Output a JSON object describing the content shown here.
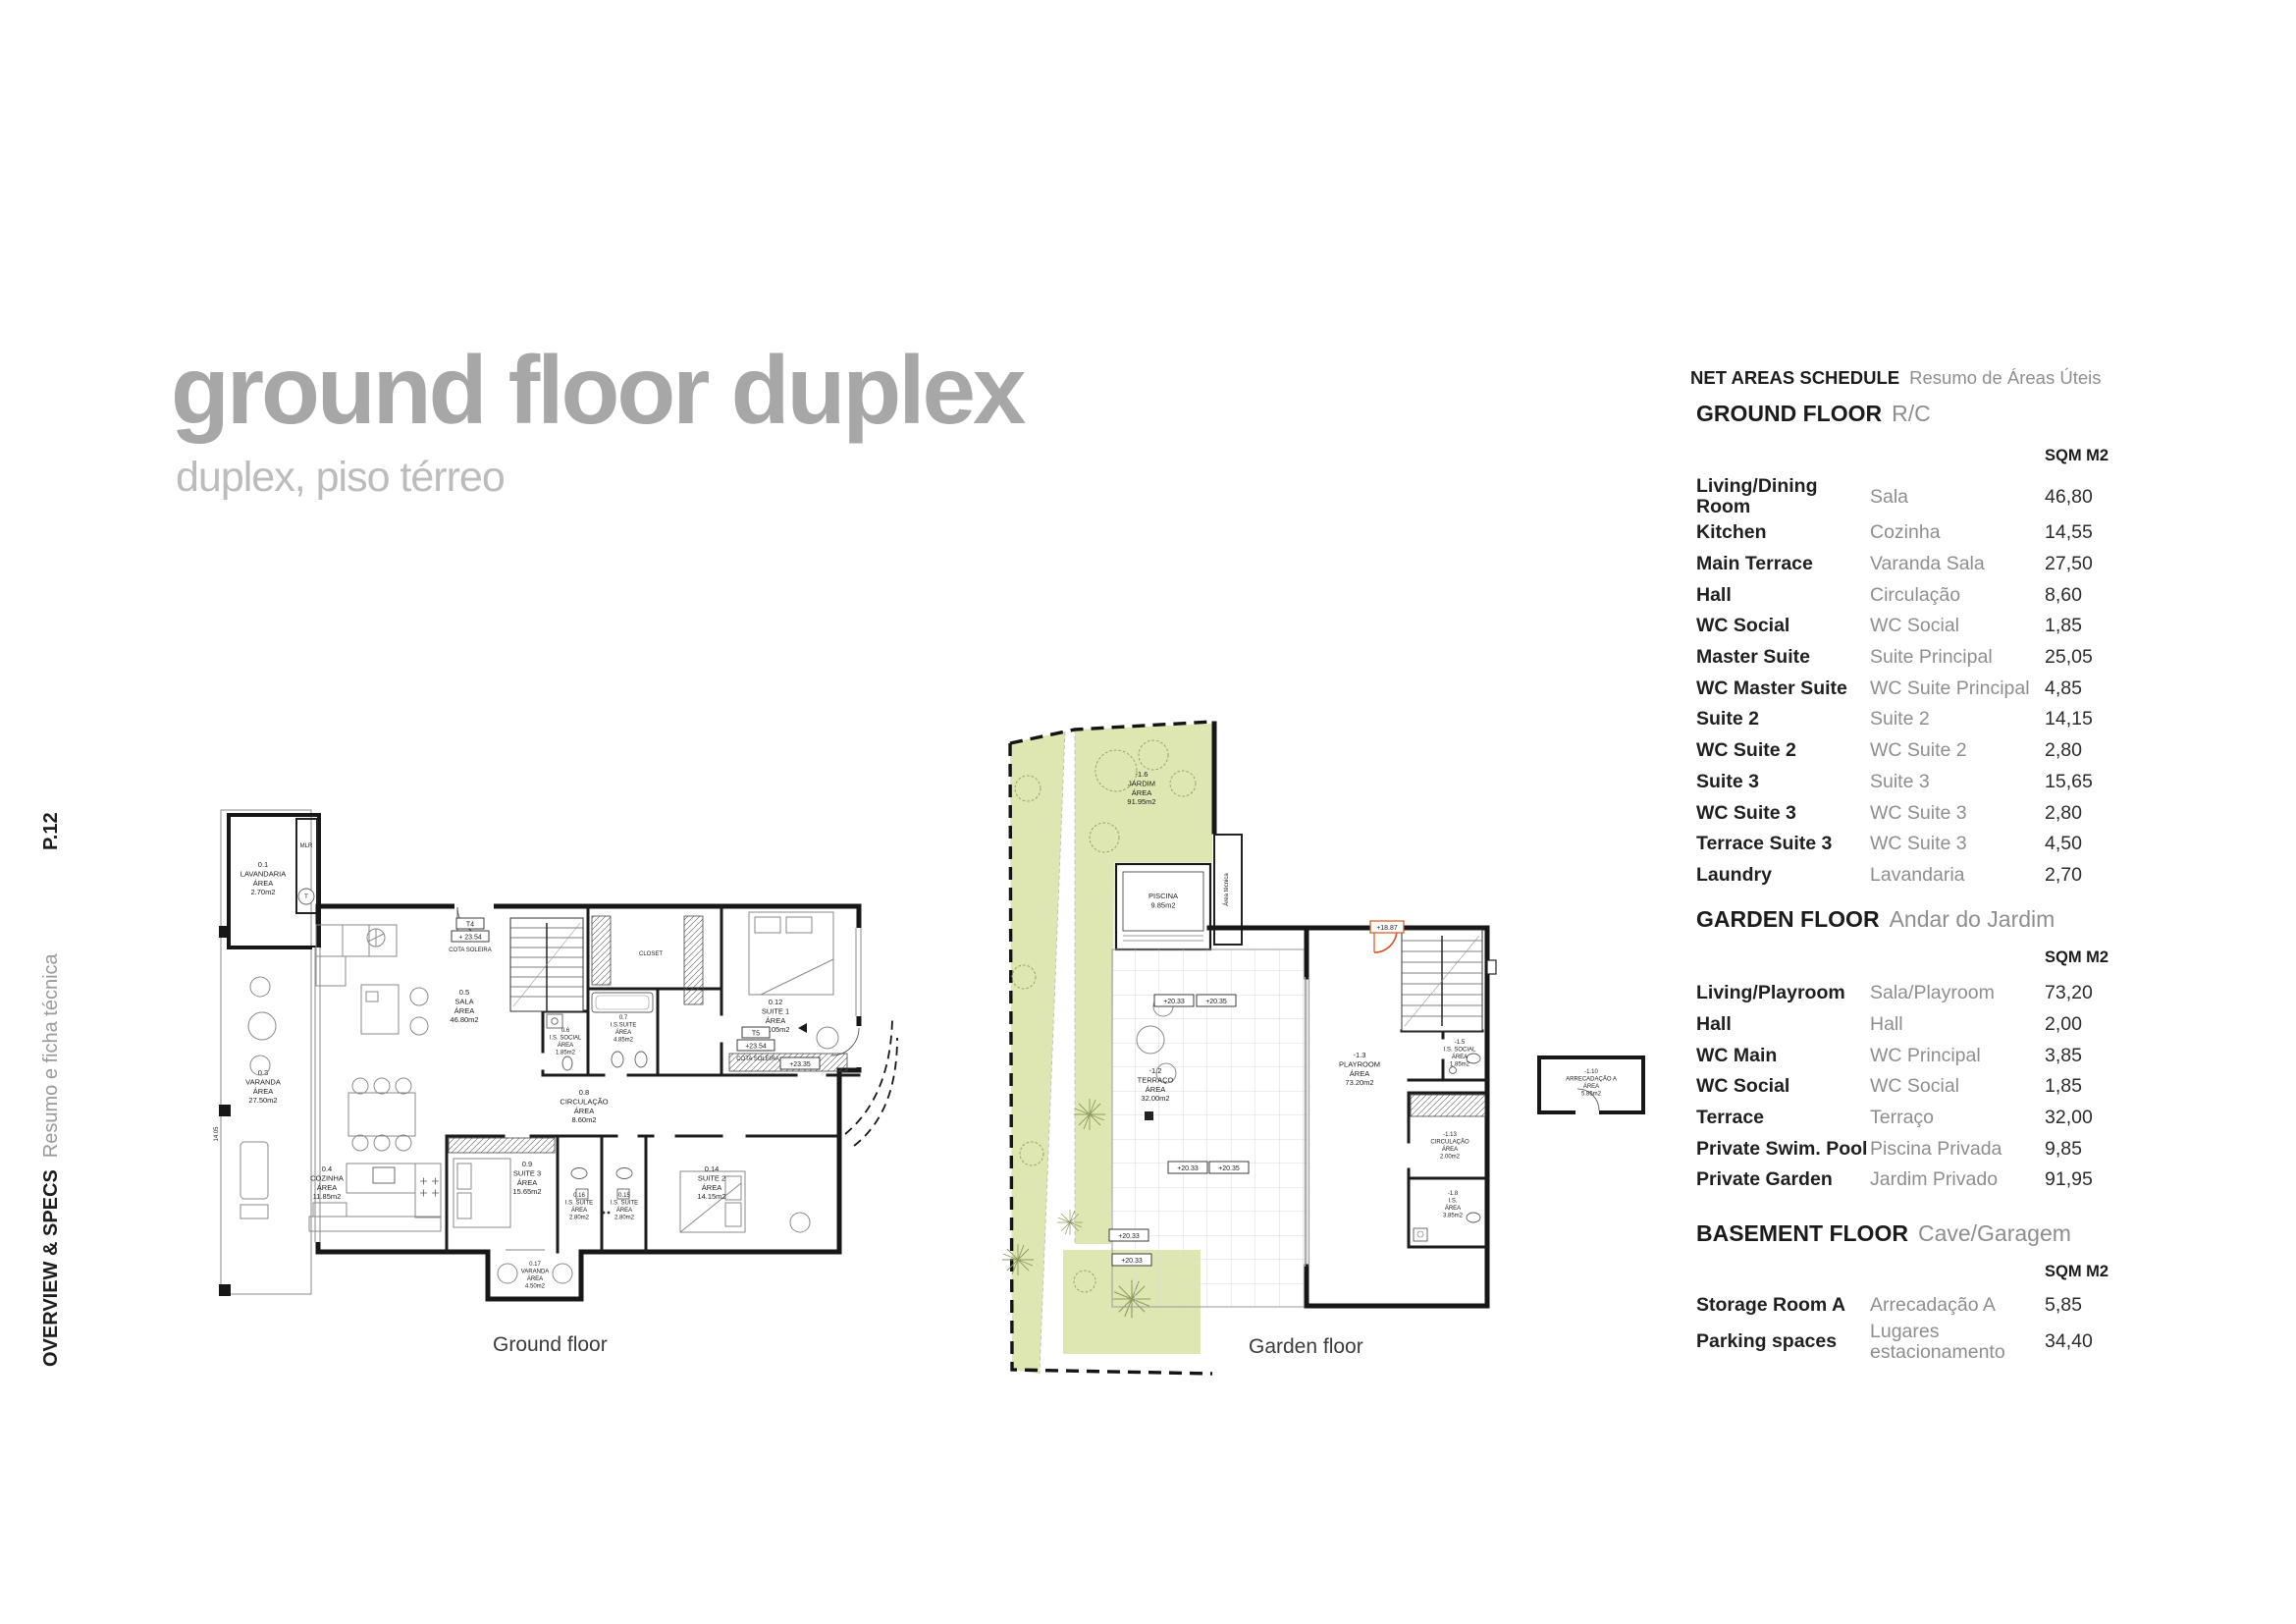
{
  "sidebar": {
    "page_number": "P.12",
    "section_en": "OVERVIEW & SPECS",
    "section_pt": "Resumo e ficha técnica"
  },
  "title": {
    "main": "ground floor duplex",
    "sub": "duplex, piso térreo"
  },
  "schedule": {
    "title_en": "NET AREAS SCHEDULE",
    "title_pt": "Resumo de Áreas Úteis",
    "area_col": "SQM M2",
    "sections": [
      {
        "name_en": "GROUND FLOOR",
        "name_pt": "R/C",
        "rows": [
          [
            "Living/Dining Room",
            "Sala",
            "46,80"
          ],
          [
            "Kitchen",
            "Cozinha",
            "14,55"
          ],
          [
            "Main Terrace",
            "Varanda Sala",
            "27,50"
          ],
          [
            "Hall",
            "Circulação",
            "8,60"
          ],
          [
            "WC Social",
            "WC Social",
            "1,85"
          ],
          [
            "Master Suite",
            "Suite Principal",
            "25,05"
          ],
          [
            "WC Master Suite",
            "WC Suite Principal",
            "4,85"
          ],
          [
            "Suite 2",
            "Suite 2",
            "14,15"
          ],
          [
            "WC Suite 2",
            "WC Suite 2",
            "2,80"
          ],
          [
            "Suite 3",
            "Suite 3",
            "15,65"
          ],
          [
            "WC Suite 3",
            "WC Suite 3",
            "2,80"
          ],
          [
            "Terrace Suite 3",
            "WC Suite 3",
            "4,50"
          ],
          [
            "Laundry",
            "Lavandaria",
            "2,70"
          ]
        ]
      },
      {
        "name_en": "GARDEN FLOOR",
        "name_pt": "Andar do Jardim",
        "rows": [
          [
            "Living/Playroom",
            "Sala/Playroom",
            "73,20"
          ],
          [
            "Hall",
            "Hall",
            "2,00"
          ],
          [
            "WC Main",
            "WC Principal",
            "3,85"
          ],
          [
            "WC Social",
            "WC Social",
            "1,85"
          ],
          [
            "Terrace",
            "Terraço",
            "32,00"
          ],
          [
            "Private Swim. Pool",
            "Piscina Privada",
            "9,85"
          ],
          [
            "Private Garden",
            "Jardim Privado",
            "91,95"
          ]
        ]
      },
      {
        "name_en": "BASEMENT FLOOR",
        "name_pt": "Cave/Garagem",
        "rows": [
          [
            "Storage Room A",
            "Arrecadação A",
            "5,85"
          ],
          [
            "Parking spaces",
            "Lugares estacionamento",
            "34,40"
          ]
        ]
      }
    ]
  },
  "plans": {
    "ground": {
      "caption": "Ground floor",
      "labels": {
        "lavandaria": [
          "0.1",
          "LAVANDARIA",
          "ÁREA",
          "2.70m2"
        ],
        "mlr": "MLR",
        "t": "T",
        "sala": [
          "0.5",
          "SALA",
          "ÁREA",
          "46.80m2"
        ],
        "varanda": [
          "0.3",
          "VARANDA",
          "ÁREA",
          "27.50m2"
        ],
        "cozinha": [
          "0.4",
          "COZINHA",
          "ÁREA",
          "11.85m2"
        ],
        "suite1": [
          "0.12",
          "SUITE 1",
          "ÁREA",
          "25.05m2"
        ],
        "suite2": [
          "0.14",
          "SUITE 2",
          "ÁREA",
          "14.15m2"
        ],
        "suite3": [
          "0.9",
          "SUITE 3",
          "ÁREA",
          "15.65m2"
        ],
        "is_suite": [
          "0.7",
          "I.S.SUITE",
          "ÁREA",
          "4.85m2"
        ],
        "is_social": [
          "0.6",
          "I.S. SOCIAL",
          "ÁREA",
          "1.85m2"
        ],
        "is_suite3": [
          "0.16",
          "I.S. SUITE",
          "ÁREA",
          "2.80m2"
        ],
        "is_suite2": [
          "0.15",
          "I.S. SUITE",
          "ÁREA",
          "2.80m2"
        ],
        "circulacao": [
          "0.8",
          "CIRCULAÇÃO",
          "ÁREA",
          "8.60m2"
        ],
        "closet": "CLOSET",
        "varanda_b": [
          "0.17",
          "VARANDA",
          "ÁREA",
          "4.50m2"
        ],
        "t4": "T4",
        "t5": "T5",
        "lvl_a": "+ 23.54",
        "lvl_b": "+23.54",
        "cota": "COTA SOLEIRA",
        "lvl_c": "+23.35",
        "dim": "14.05"
      }
    },
    "garden": {
      "caption": "Garden floor",
      "labels": {
        "jardim": [
          "-1.6",
          "JARDIM",
          "ÁREA",
          "91.95m2"
        ],
        "piscina": [
          "PISCINA",
          "9.85m2"
        ],
        "tecnica": "Área técnica",
        "terraco": [
          "-1.2",
          "TERRAÇO",
          "ÁREA",
          "32.00m2"
        ],
        "playroom": [
          "-1.3",
          "PLAYROOM",
          "ÁREA",
          "73.20m2"
        ],
        "circulacao": [
          "-1.13",
          "CIRCULAÇÃO",
          "ÁREA",
          "2.00m2"
        ],
        "is": [
          "-1.8",
          "I.S.",
          "ÁREA",
          "3.85m2"
        ],
        "is_social": [
          "-1.5",
          "I.S. SOCIAL",
          "ÁREA",
          "1.85m2"
        ],
        "arrecadacao": [
          "-1.10",
          "ARRECADAÇÃO A",
          "ÁREA",
          "5.85m2"
        ],
        "m2033": "+20.33",
        "m2035": "+20.35",
        "m1887": "+18.87"
      }
    }
  },
  "colors": {
    "garden_green": "#dee7b2",
    "wall": "#171717",
    "door_orange": "#e0521d",
    "title_gray": "#a7a7a7",
    "muted_text": "#8e8e8e"
  }
}
